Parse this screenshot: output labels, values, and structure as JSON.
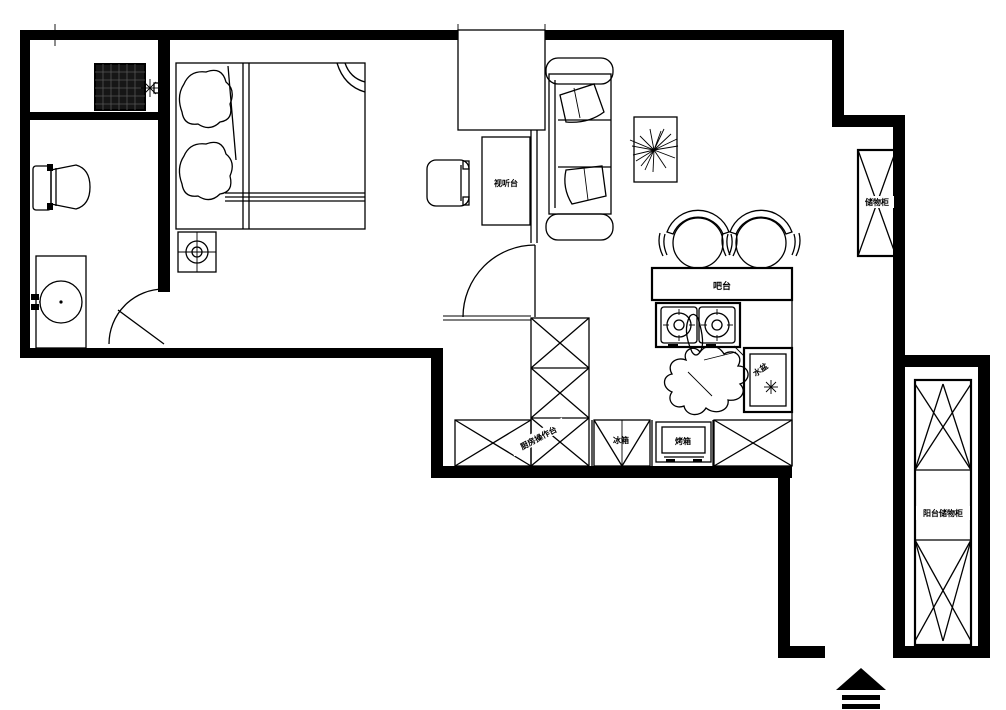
{
  "colors": {
    "ink": "#000000",
    "paper": "#ffffff"
  },
  "plan": {
    "type": "apartment-floor-plan",
    "labels": {
      "tv_console": "视听台",
      "bar": "吧台",
      "sink": "水盆",
      "fridge": "冰箱",
      "oven": "烤箱",
      "kitchen_counter": "厨房操作台",
      "living_cabinet": "储物柜",
      "balcony_cabinet": "阳台储物柜"
    },
    "rooms": [
      {
        "name": "bathroom",
        "furniture": [
          "washing-machine",
          "shower-faucet",
          "toilet",
          "vanity-basin",
          "door-swing"
        ]
      },
      {
        "name": "bedroom",
        "furniture": [
          "double-bed",
          "pillows",
          "nightstand-with-lamp"
        ]
      },
      {
        "name": "hallway",
        "furniture": [
          "armchair",
          "tv-console",
          "door-swing"
        ]
      },
      {
        "name": "living-dining",
        "furniture": [
          "sofa",
          "plant-table",
          "dining-chair",
          "dining-chair",
          "bar-counter",
          "gas-stove",
          "sink-cabinet",
          "wall-cabinet"
        ]
      },
      {
        "name": "kitchen",
        "furniture": [
          "l-shaped-counter",
          "refrigerator",
          "oven",
          "base-cabinet"
        ]
      },
      {
        "name": "entry-balcony",
        "furniture": [
          "tall-storage-cabinet",
          "entrance-arrow"
        ]
      }
    ]
  }
}
